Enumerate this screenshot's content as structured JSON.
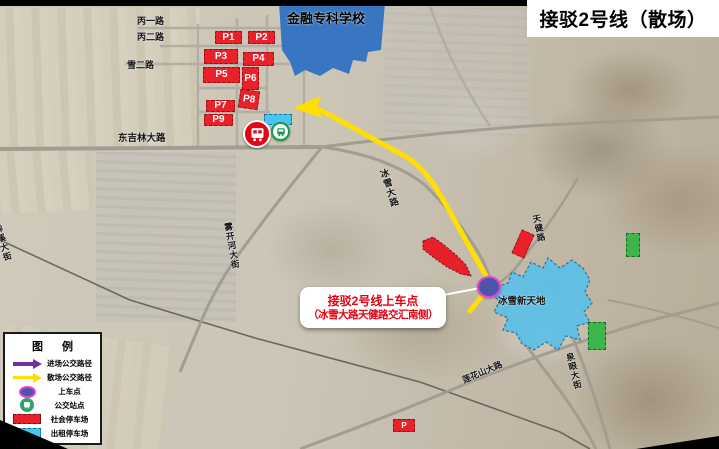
{
  "header": {
    "title": "接驳2号线（散场）"
  },
  "areas": {
    "school": "金融专科学校",
    "venue": "冰雪新天地"
  },
  "callout": {
    "line1": "接驳2号线上车点",
    "line2": "（冰雪大路天健路交汇南侧）"
  },
  "roads": {
    "bing_yi": "丙一路",
    "bing_er": "丙二路",
    "xue_er": "雪二路",
    "dong_jilin": "东吉林大路",
    "wukaihe": "雾开河大街",
    "bingxue": "冰雪大路",
    "tianjian": "天健路",
    "quanyan": "泉眼大街",
    "lianhuashan": "莲花山大路",
    "liuxi": "柳溪大街"
  },
  "parking": {
    "lots": [
      {
        "label": "P1"
      },
      {
        "label": "P2"
      },
      {
        "label": "P3"
      },
      {
        "label": "P4"
      },
      {
        "label": "P5"
      },
      {
        "label": "P6"
      },
      {
        "label": "P7"
      },
      {
        "label": "P8"
      },
      {
        "label": "P9"
      }
    ],
    "extra_label": "P"
  },
  "legend": {
    "title": "图 例",
    "items": [
      {
        "label": "进场公交路径",
        "swatch": "purple-arrow"
      },
      {
        "label": "散场公交路径",
        "swatch": "yellow-arrow"
      },
      {
        "label": "上车点",
        "swatch": "boarding-dot"
      },
      {
        "label": "公交站点",
        "swatch": "bus-stop"
      },
      {
        "label": "社会停车场",
        "swatch": "red-dashed-rect"
      },
      {
        "label": "出租停车场",
        "swatch": "cyan-dashed-rect"
      }
    ]
  },
  "colors": {
    "exit_route": "#ffdf00",
    "enter_route": "#7030a0",
    "public_parking": "#e8212b",
    "taxi_parking": "#49c6ee",
    "school_fill": "#2d6fc2",
    "venue_fill": "#5fc0e6",
    "boarding_fill": "#4b56a9",
    "boarding_border": "#e93fd4",
    "bus_stop_red": "#e30613"
  }
}
